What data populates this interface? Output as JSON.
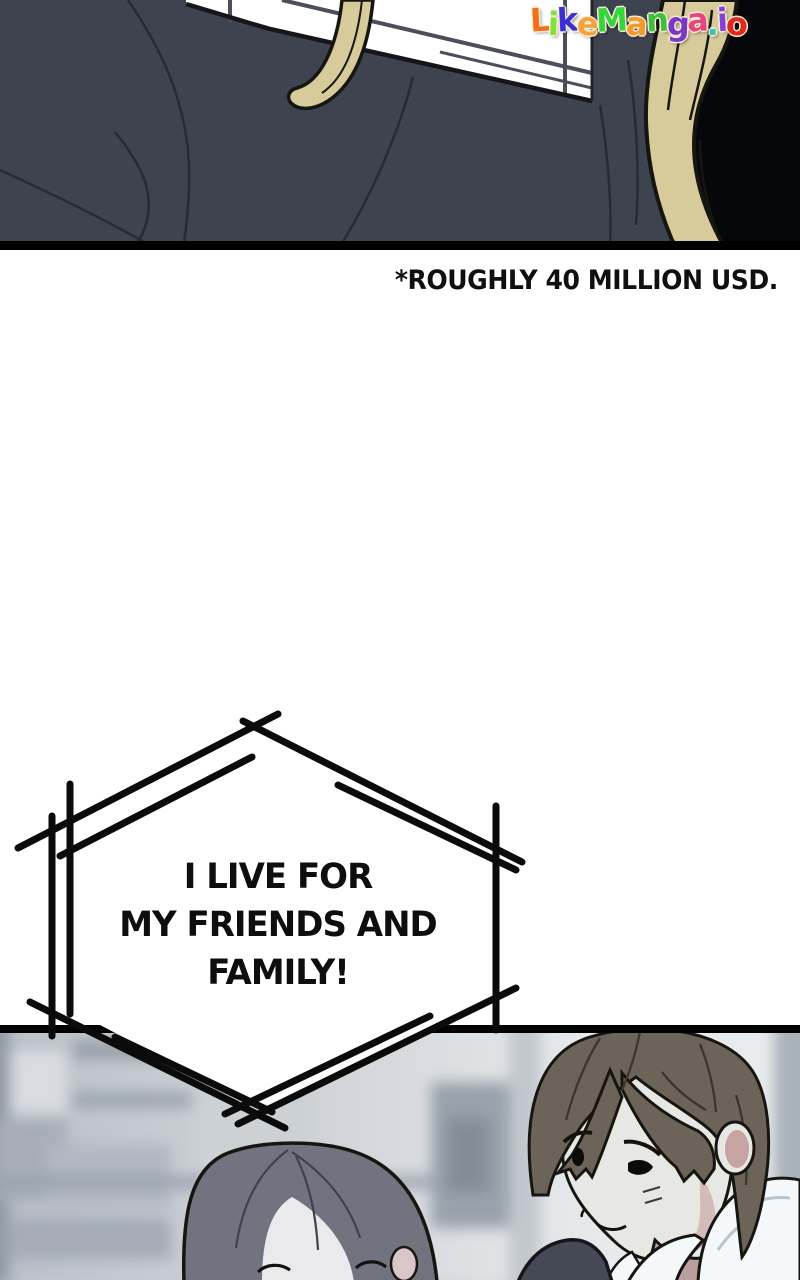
{
  "type": "webtoon-comic-page",
  "watermark": {
    "text": "LikeManga.io",
    "letters": [
      {
        "ch": "L",
        "color": "#f2701d"
      },
      {
        "ch": "i",
        "color": "#7de23c"
      },
      {
        "ch": "k",
        "color": "#3b2fd4"
      },
      {
        "ch": "e",
        "color": "#f2a33c"
      },
      {
        "ch": "M",
        "color": "#35d53c"
      },
      {
        "ch": "a",
        "color": "#f29a2e"
      },
      {
        "ch": "n",
        "color": "#3bc13b"
      },
      {
        "ch": "g",
        "color": "#7a35c9"
      },
      {
        "ch": "a",
        "color": "#e8457f"
      },
      {
        "ch": ".",
        "color": "#2fc9b4"
      },
      {
        "ch": "i",
        "color": "#8a3fd4"
      },
      {
        "ch": "o",
        "color": "#e0281e"
      }
    ]
  },
  "caption": {
    "text": "*ROUGHLY 40 MILLION USD."
  },
  "speech_bubble": {
    "shape": "sketched-hexagon",
    "lines": [
      "I LIVE FOR",
      "MY FRIENDS AND",
      "FAMILY!"
    ]
  },
  "panels": [
    {
      "id": "top",
      "description": "dark-suited figure seen from behind, white window with grid, blonde hair strands at right on black"
    },
    {
      "id": "bottom",
      "description": "blurred room interior; gray-haired woman smiling with closed eyes at left, brown-haired man in white collar shirt at right"
    }
  ],
  "theme": {
    "page_bg": "#ffffff",
    "panel_black": "#06070a",
    "suit": "#3e4350",
    "suit_fold": "#262b36",
    "window_grid": "#4a4f5a",
    "outline": "#17150f",
    "hair_blonde": "#d8cb9b",
    "bubble_stroke": "#0b0b0b",
    "skin": "#e7e7e4",
    "woman_hair": "#71747f",
    "woman_face": "#eaeaed",
    "man_hair": "#6d6459",
    "collar_white": "#f4f8fa",
    "collar_shadow": "#b9c5ce",
    "jacket_dark": "#454956",
    "neck_blush": "#bb9fa0",
    "ear_blush": "#c7a3a3",
    "bg_blur_base": "#c6cbd1"
  }
}
